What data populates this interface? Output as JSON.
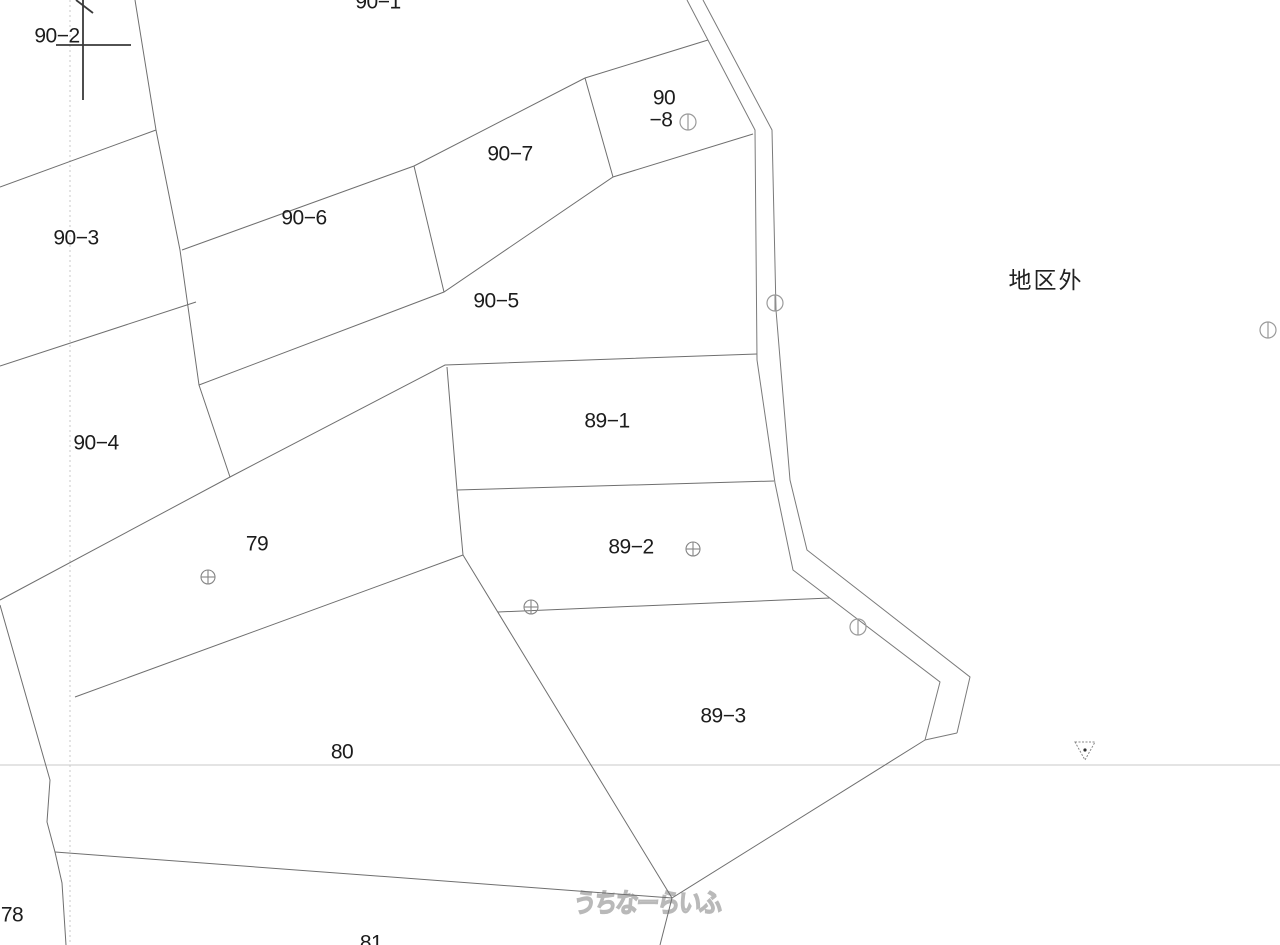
{
  "map": {
    "width": 1280,
    "height": 945,
    "background": "#ffffff",
    "boundary_color": "#6f6f6f",
    "road_color": "#7a7a7a",
    "label_color": "#1c1c1c",
    "label_font_size": 21,
    "grid_color": "#c8c8c8",
    "outside_district_label": {
      "text": "地区外",
      "x": 1046,
      "y": 282,
      "font_size": 23,
      "color": "#222222"
    },
    "watermark": {
      "text": "うちなーらいふ",
      "x": 646,
      "y": 912,
      "font_size": 23,
      "stroke": "#b9b9b9",
      "fill": "#f7f7f7"
    },
    "grid_lines": [
      {
        "type": "v",
        "pos": 70
      },
      {
        "type": "h",
        "pos": 765
      }
    ],
    "parcel_labels": [
      {
        "id": "90-1",
        "lines": [
          {
            "text": "90-1",
            "x": 378,
            "y": 3
          }
        ]
      },
      {
        "id": "90-2",
        "lines": [
          {
            "text": "90-2",
            "x": 57,
            "y": 37
          }
        ]
      },
      {
        "id": "90-3",
        "lines": [
          {
            "text": "90-3",
            "x": 76,
            "y": 239
          }
        ]
      },
      {
        "id": "90-4",
        "lines": [
          {
            "text": "90-4",
            "x": 96,
            "y": 444
          }
        ]
      },
      {
        "id": "90-5",
        "lines": [
          {
            "text": "90-5",
            "x": 496,
            "y": 302
          }
        ]
      },
      {
        "id": "90-6",
        "lines": [
          {
            "text": "90-6",
            "x": 304,
            "y": 219
          }
        ]
      },
      {
        "id": "90-7",
        "lines": [
          {
            "text": "90-7",
            "x": 510,
            "y": 155
          }
        ]
      },
      {
        "id": "90-8",
        "lines": [
          {
            "text": "90",
            "x": 664,
            "y": 99
          },
          {
            "text": "-8",
            "x": 661,
            "y": 121
          }
        ]
      },
      {
        "id": "89-1",
        "lines": [
          {
            "text": "89-1",
            "x": 607,
            "y": 422
          }
        ]
      },
      {
        "id": "89-2",
        "lines": [
          {
            "text": "89-2",
            "x": 631,
            "y": 548
          }
        ]
      },
      {
        "id": "89-3",
        "lines": [
          {
            "text": "89-3",
            "x": 723,
            "y": 717
          }
        ]
      },
      {
        "id": "79",
        "lines": [
          {
            "text": "79",
            "x": 257,
            "y": 545
          }
        ]
      },
      {
        "id": "80",
        "lines": [
          {
            "text": "80",
            "x": 342,
            "y": 753
          }
        ]
      },
      {
        "id": "78",
        "lines": [
          {
            "text": "78",
            "x": 12,
            "y": 916
          }
        ]
      },
      {
        "id": "81",
        "lines": [
          {
            "text": "81",
            "x": 371,
            "y": 944
          }
        ]
      }
    ],
    "boundaries": [
      {
        "name": "b-west-spine",
        "points": [
          [
            135,
            0
          ],
          [
            156,
            130
          ],
          [
            180,
            250
          ],
          [
            199,
            385
          ],
          [
            230,
            477
          ]
        ]
      },
      {
        "name": "b-90-2-90-3",
        "points": [
          [
            0,
            187
          ],
          [
            156,
            130
          ]
        ]
      },
      {
        "name": "b-90-3-90-4",
        "points": [
          [
            0,
            366
          ],
          [
            196,
            302
          ]
        ]
      },
      {
        "name": "b-strip-top",
        "points": [
          [
            182,
            250
          ],
          [
            414,
            166
          ],
          [
            585,
            78
          ],
          [
            708,
            40
          ]
        ]
      },
      {
        "name": "b-90-6-90-7",
        "points": [
          [
            414,
            166
          ],
          [
            444,
            292
          ]
        ]
      },
      {
        "name": "b-90-7-90-8",
        "points": [
          [
            585,
            78
          ],
          [
            613,
            177
          ]
        ]
      },
      {
        "name": "b-strip-bottom",
        "points": [
          [
            199,
            385
          ],
          [
            444,
            292
          ],
          [
            613,
            177
          ],
          [
            753,
            134
          ]
        ]
      },
      {
        "name": "b-north-79-89-1",
        "points": [
          [
            0,
            600
          ],
          [
            230,
            477
          ],
          [
            445,
            365
          ],
          [
            757,
            354
          ]
        ]
      },
      {
        "name": "b-89-left-edge",
        "points": [
          [
            447,
            367
          ],
          [
            457,
            490
          ],
          [
            463,
            555
          ]
        ]
      },
      {
        "name": "b-89-1-89-2",
        "points": [
          [
            457,
            490
          ],
          [
            774,
            481
          ]
        ]
      },
      {
        "name": "b-79-80",
        "points": [
          [
            463,
            555
          ],
          [
            75,
            697
          ]
        ]
      },
      {
        "name": "b-78-west",
        "points": [
          [
            0,
            605
          ],
          [
            50,
            780
          ],
          [
            47,
            822
          ],
          [
            55,
            852
          ],
          [
            62,
            883
          ],
          [
            66,
            945
          ]
        ]
      },
      {
        "name": "b-80-81",
        "points": [
          [
            55,
            852
          ],
          [
            672,
            898
          ]
        ]
      },
      {
        "name": "b-80-89-3",
        "points": [
          [
            463,
            555
          ],
          [
            672,
            898
          ]
        ]
      },
      {
        "name": "b-89-2-89-3",
        "points": [
          [
            498,
            612
          ],
          [
            830,
            598
          ]
        ]
      },
      {
        "name": "b-89-3-road-end",
        "points": [
          [
            925,
            740
          ],
          [
            672,
            898
          ]
        ]
      },
      {
        "name": "b-junction-south",
        "points": [
          [
            672,
            898
          ],
          [
            660,
            945
          ]
        ]
      }
    ],
    "road": {
      "inner": [
        [
          687,
          0
        ],
        [
          755,
          130
        ],
        [
          757,
          360
        ],
        [
          775,
          483
        ],
        [
          793,
          570
        ],
        [
          940,
          682
        ],
        [
          925,
          740
        ]
      ],
      "outer": [
        [
          703,
          0
        ],
        [
          772,
          130
        ],
        [
          776,
          310
        ],
        [
          790,
          480
        ],
        [
          807,
          550
        ],
        [
          970,
          677
        ],
        [
          957,
          733
        ]
      ],
      "end_cap": [
        [
          925,
          740
        ],
        [
          957,
          733
        ]
      ]
    },
    "survey_cross": {
      "color": "#3a3a3a",
      "segments": [
        [
          [
            83,
            0
          ],
          [
            83,
            100
          ]
        ],
        [
          [
            56,
            45
          ],
          [
            131,
            45
          ]
        ],
        [
          [
            76,
            0
          ],
          [
            93,
            13
          ]
        ]
      ]
    },
    "markers": {
      "circle_vline": {
        "color": "#9a9a9a",
        "radius": 8,
        "points": [
          [
            688,
            122
          ],
          [
            775,
            303
          ],
          [
            858,
            627
          ],
          [
            1268,
            330
          ]
        ]
      },
      "circle_cross": {
        "color": "#858585",
        "radius": 7,
        "points": [
          [
            208,
            577
          ],
          [
            531,
            607
          ],
          [
            693,
            549
          ]
        ]
      }
    },
    "benchmark_triangle": {
      "cx": 1085,
      "cy": 751,
      "half_w": 10,
      "h": 18,
      "color": "#888888",
      "dot_color": "#333333"
    }
  }
}
